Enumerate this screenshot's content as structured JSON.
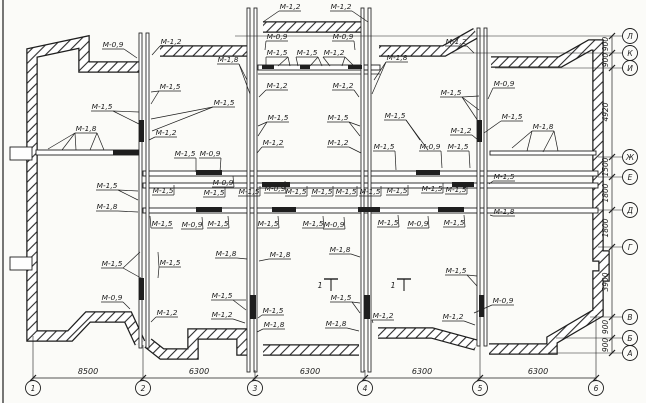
{
  "drawing": {
    "title": "floor-plan-with-mortar-marks",
    "canvas": {
      "w": 646,
      "h": 403
    },
    "colors": {
      "ink": "#1e1e1e",
      "paper": "#fbfbf8",
      "wall_fill": "#ffffff"
    },
    "frame_line_x": 3
  },
  "walls": {
    "outer_path": "M140,343 L128,317 L88,317 L70,336 L32,336 L32,53 L84,42 L84,67 L140,67 M160,51 L247,51 M263,27 L364,27 M379,51 L444,51 L476,33 M491,62 L560,62 L590,45 L598,45 L598,256 L604,256 L604,276 L598,276 L598,313 L552,340 L552,349 L489,349 M476,345 L432,333 L378,333 M359,350 L263,350 M247,350 L242,350 L242,334 L193,334 L193,354 L162,354 L148,343",
    "outline_width": 11.5,
    "hatch_width": 9,
    "inner": [
      {
        "x": 36,
        "y": 150,
        "w": 104,
        "h": 5
      },
      {
        "x": 490,
        "y": 151,
        "w": 106,
        "h": 4
      },
      {
        "x": 143,
        "y": 171,
        "w": 455,
        "h": 5
      },
      {
        "x": 143,
        "y": 183,
        "w": 455,
        "h": 5
      },
      {
        "x": 143,
        "y": 208,
        "w": 455,
        "h": 5
      },
      {
        "x": 258,
        "y": 65,
        "w": 122,
        "h": 5
      }
    ],
    "thin_lines": [
      {
        "x1": 258,
        "y1": 74,
        "x2": 380,
        "y2": 74
      }
    ],
    "shafts": [
      {
        "x": 139,
        "y": 33,
        "w": 3,
        "h": 315
      },
      {
        "x": 146,
        "y": 33,
        "w": 3,
        "h": 315
      },
      {
        "x": 247,
        "y": 8,
        "w": 3,
        "h": 364
      },
      {
        "x": 254,
        "y": 8,
        "w": 3,
        "h": 364
      },
      {
        "x": 361,
        "y": 8,
        "w": 3,
        "h": 364
      },
      {
        "x": 368,
        "y": 8,
        "w": 3,
        "h": 364
      },
      {
        "x": 477,
        "y": 28,
        "w": 3,
        "h": 318
      },
      {
        "x": 484,
        "y": 28,
        "w": 3,
        "h": 318
      }
    ],
    "black_segments": [
      [
        139,
        120,
        5,
        22
      ],
      [
        139,
        278,
        5,
        22
      ],
      [
        250,
        295,
        6,
        24
      ],
      [
        364,
        295,
        6,
        24
      ],
      [
        477,
        120,
        5,
        22
      ],
      [
        479,
        295,
        5,
        22
      ],
      [
        113,
        150,
        26,
        5
      ],
      [
        262,
        65,
        12,
        4
      ],
      [
        300,
        65,
        10,
        4
      ],
      [
        348,
        65,
        14,
        4
      ],
      [
        196,
        170,
        26,
        5
      ],
      [
        416,
        170,
        24,
        5
      ],
      [
        262,
        182,
        28,
        5
      ],
      [
        452,
        182,
        22,
        5
      ],
      [
        196,
        207,
        26,
        5
      ],
      [
        272,
        207,
        24,
        5
      ],
      [
        358,
        207,
        22,
        5
      ],
      [
        438,
        207,
        26,
        5
      ]
    ],
    "tabs": [
      [
        10,
        147,
        22,
        13
      ],
      [
        10,
        257,
        22,
        13
      ]
    ]
  },
  "labels": [
    {
      "t": "М-1,2",
      "x": 290,
      "y": 7,
      "to": [
        [
          263,
          22
        ]
      ]
    },
    {
      "t": "М-1,2",
      "x": 341,
      "y": 7,
      "to": [
        [
          368,
          22
        ]
      ]
    },
    {
      "t": "М-0,9",
      "x": 113,
      "y": 45,
      "to": [
        [
          137,
          58
        ]
      ]
    },
    {
      "t": "М-1,2",
      "x": 171,
      "y": 42,
      "to": [
        [
          152,
          55
        ]
      ]
    },
    {
      "t": "М-0,9",
      "x": 277,
      "y": 37,
      "to": [
        [
          265,
          50
        ]
      ]
    },
    {
      "t": "М-0,9",
      "x": 343,
      "y": 37,
      "to": [
        [
          355,
          50
        ]
      ]
    },
    {
      "t": "М-1,2",
      "x": 456,
      "y": 42,
      "to": [
        [
          474,
          53
        ]
      ]
    },
    {
      "t": "М-1,8",
      "x": 228,
      "y": 60,
      "to": [
        [
          247,
          80
        ],
        [
          250,
          94
        ]
      ]
    },
    {
      "t": "М-1,5",
      "x": 277,
      "y": 53,
      "to": [
        [
          266,
          66
        ],
        [
          278,
          66
        ],
        [
          290,
          66
        ]
      ]
    },
    {
      "t": "М-1,5",
      "x": 307,
      "y": 53,
      "to": [
        [
          298,
          66
        ],
        [
          310,
          66
        ],
        [
          322,
          66
        ]
      ]
    },
    {
      "t": "М-1,2",
      "x": 334,
      "y": 53,
      "to": [
        [
          330,
          66
        ],
        [
          342,
          66
        ],
        [
          354,
          66
        ]
      ]
    },
    {
      "t": "М-1,8",
      "x": 397,
      "y": 58,
      "to": [
        [
          374,
          80
        ],
        [
          372,
          94
        ]
      ]
    },
    {
      "t": "М-0,9",
      "x": 504,
      "y": 84,
      "to": [
        [
          488,
          99
        ]
      ]
    },
    {
      "t": "М-1,5",
      "x": 451,
      "y": 93,
      "to": [
        [
          479,
          96
        ],
        [
          479,
          110
        ],
        [
          480,
          124
        ]
      ]
    },
    {
      "t": "М-1,5",
      "x": 512,
      "y": 117,
      "to": [
        [
          484,
          133
        ]
      ]
    },
    {
      "t": "М-1,2",
      "x": 461,
      "y": 131,
      "to": [
        [
          478,
          140
        ]
      ]
    },
    {
      "t": "М-1,8",
      "x": 543,
      "y": 127,
      "to": [
        [
          512,
          148
        ],
        [
          527,
          151
        ],
        [
          543,
          152
        ],
        [
          558,
          151
        ]
      ]
    },
    {
      "t": "М-1,5",
      "x": 170,
      "y": 87,
      "to": [
        [
          151,
          92
        ],
        [
          151,
          104
        ]
      ]
    },
    {
      "t": "М-1,5",
      "x": 102,
      "y": 107,
      "to": [
        [
          139,
          112
        ],
        [
          139,
          124
        ]
      ]
    },
    {
      "t": "М-1,8",
      "x": 86,
      "y": 129,
      "to": [
        [
          48,
          149
        ],
        [
          62,
          150
        ],
        [
          76,
          150
        ],
        [
          90,
          150
        ],
        [
          104,
          150
        ]
      ]
    },
    {
      "t": "М-1,2",
      "x": 166,
      "y": 133,
      "to": [
        [
          149,
          140
        ]
      ]
    },
    {
      "t": "М-1,5",
      "x": 224,
      "y": 103,
      "to": [
        [
          151,
          119
        ],
        [
          152,
          131
        ]
      ]
    },
    {
      "t": "М-1,2",
      "x": 277,
      "y": 86,
      "to": [
        [
          259,
          97
        ]
      ]
    },
    {
      "t": "М-1,2",
      "x": 343,
      "y": 86,
      "to": [
        [
          359,
          97
        ]
      ]
    },
    {
      "t": "М-1,5",
      "x": 278,
      "y": 118,
      "to": [
        [
          258,
          126
        ],
        [
          258,
          136
        ]
      ]
    },
    {
      "t": "М-1,5",
      "x": 338,
      "y": 118,
      "to": [
        [
          360,
          126
        ],
        [
          360,
          136
        ]
      ]
    },
    {
      "t": "М-1,2",
      "x": 273,
      "y": 143,
      "to": [
        [
          257,
          153
        ]
      ]
    },
    {
      "t": "М-1,2",
      "x": 338,
      "y": 143,
      "to": [
        [
          361,
          153
        ]
      ]
    },
    {
      "t": "М-1,5",
      "x": 395,
      "y": 116,
      "to": [
        [
          420,
          140
        ],
        [
          428,
          150
        ]
      ]
    },
    {
      "t": "М-1,5",
      "x": 185,
      "y": 154,
      "to": [
        [
          196,
          172
        ]
      ]
    },
    {
      "t": "М-0,9",
      "x": 210,
      "y": 154,
      "to": [
        [
          220,
          172
        ]
      ]
    },
    {
      "t": "М-1,5",
      "x": 163,
      "y": 191,
      "to": [
        [
          174,
          185
        ]
      ]
    },
    {
      "t": "М-0,9",
      "x": 223,
      "y": 183,
      "to": [
        [
          233,
          176
        ]
      ]
    },
    {
      "t": "М-1,5",
      "x": 214,
      "y": 193,
      "to": [
        [
          225,
          187
        ]
      ]
    },
    {
      "t": "М-1,5",
      "x": 249,
      "y": 192,
      "to": [
        [
          260,
          186
        ]
      ]
    },
    {
      "t": "М-0,9",
      "x": 275,
      "y": 189,
      "to": [
        [
          285,
          181
        ]
      ]
    },
    {
      "t": "М-1,5",
      "x": 296,
      "y": 192,
      "to": [
        [
          307,
          186
        ]
      ]
    },
    {
      "t": "М-1,5",
      "x": 322,
      "y": 192,
      "to": [
        [
          333,
          186
        ]
      ]
    },
    {
      "t": "М-1,5",
      "x": 346,
      "y": 192,
      "to": [
        [
          357,
          186
        ]
      ]
    },
    {
      "t": "М-1,5",
      "x": 370,
      "y": 192,
      "to": [
        [
          381,
          186
        ]
      ]
    },
    {
      "t": "М-1,5",
      "x": 397,
      "y": 191,
      "to": [
        [
          408,
          185
        ]
      ]
    },
    {
      "t": "М-1,5",
      "x": 432,
      "y": 189,
      "to": [
        [
          443,
          183
        ]
      ]
    },
    {
      "t": "М-1,5",
      "x": 456,
      "y": 190,
      "to": [
        [
          467,
          184
        ]
      ]
    },
    {
      "t": "М-1,5",
      "x": 384,
      "y": 147,
      "to": [
        [
          396,
          170
        ]
      ]
    },
    {
      "t": "М-0,9",
      "x": 430,
      "y": 147,
      "to": [
        [
          442,
          168
        ]
      ]
    },
    {
      "t": "М-1,5",
      "x": 458,
      "y": 147,
      "to": [
        [
          470,
          168
        ]
      ]
    },
    {
      "t": "М-1,5",
      "x": 504,
      "y": 177,
      "to": [
        [
          489,
          184
        ]
      ]
    },
    {
      "t": "М-1,8",
      "x": 504,
      "y": 212,
      "to": [
        [
          490,
          215
        ]
      ]
    },
    {
      "t": "М-1,5",
      "x": 162,
      "y": 224,
      "to": [
        [
          150,
          216
        ]
      ]
    },
    {
      "t": "М-0,9",
      "x": 192,
      "y": 225,
      "to": [
        [
          202,
          217
        ]
      ]
    },
    {
      "t": "М-1,5",
      "x": 218,
      "y": 224,
      "to": [
        [
          228,
          216
        ]
      ]
    },
    {
      "t": "М-1,5",
      "x": 268,
      "y": 224,
      "to": [
        [
          278,
          216
        ]
      ]
    },
    {
      "t": "М-1,5",
      "x": 313,
      "y": 224,
      "to": [
        [
          323,
          216
        ]
      ]
    },
    {
      "t": "М-0,9",
      "x": 334,
      "y": 225,
      "to": [
        [
          344,
          217
        ]
      ]
    },
    {
      "t": "М-1,5",
      "x": 388,
      "y": 223,
      "to": [
        [
          398,
          215
        ]
      ]
    },
    {
      "t": "М-0,9",
      "x": 418,
      "y": 224,
      "to": [
        [
          428,
          216
        ]
      ]
    },
    {
      "t": "М-1,5",
      "x": 454,
      "y": 223,
      "to": [
        [
          464,
          215
        ]
      ]
    },
    {
      "t": "М-1,8",
      "x": 226,
      "y": 254,
      "to": [
        [
          247,
          259
        ]
      ]
    },
    {
      "t": "М-1,8",
      "x": 280,
      "y": 255,
      "to": [
        [
          259,
          261
        ]
      ]
    },
    {
      "t": "М-1,8",
      "x": 340,
      "y": 250,
      "to": [
        [
          360,
          257
        ]
      ]
    },
    {
      "t": "М-1,5",
      "x": 107,
      "y": 186,
      "to": [
        [
          138,
          191
        ],
        [
          138,
          200
        ]
      ]
    },
    {
      "t": "М-1,8",
      "x": 107,
      "y": 207,
      "to": [
        [
          138,
          212
        ]
      ]
    },
    {
      "t": "М-1,5",
      "x": 112,
      "y": 264,
      "to": [
        [
          140,
          252
        ],
        [
          141,
          278
        ]
      ]
    },
    {
      "t": "М-1,5",
      "x": 170,
      "y": 263,
      "to": [
        [
          158,
          252
        ],
        [
          158,
          278
        ]
      ]
    },
    {
      "t": "М-0,9",
      "x": 112,
      "y": 298,
      "to": [
        [
          130,
          309
        ]
      ]
    },
    {
      "t": "М-1,2",
      "x": 167,
      "y": 313,
      "to": [
        [
          151,
          322
        ]
      ]
    },
    {
      "t": "М-1,5",
      "x": 222,
      "y": 296,
      "to": [
        [
          246,
          300
        ],
        [
          246,
          310
        ]
      ]
    },
    {
      "t": "М-1,2",
      "x": 222,
      "y": 315,
      "to": [
        [
          245,
          323
        ]
      ]
    },
    {
      "t": "М-1,5",
      "x": 273,
      "y": 311,
      "to": [
        [
          258,
          318
        ]
      ]
    },
    {
      "t": "М-1,8",
      "x": 274,
      "y": 325,
      "to": [
        [
          257,
          332
        ]
      ]
    },
    {
      "t": "М-1,5",
      "x": 341,
      "y": 298,
      "to": [
        [
          360,
          303
        ],
        [
          360,
          313
        ]
      ]
    },
    {
      "t": "М-1,8",
      "x": 336,
      "y": 324,
      "to": [
        [
          359,
          331
        ]
      ]
    },
    {
      "t": "М-1,2",
      "x": 383,
      "y": 316,
      "to": [
        [
          373,
          323
        ]
      ]
    },
    {
      "t": "М-1,5",
      "x": 456,
      "y": 271,
      "to": [
        [
          477,
          276
        ],
        [
          477,
          286
        ]
      ]
    },
    {
      "t": "М-0,9",
      "x": 503,
      "y": 301,
      "to": [
        [
          474,
          313
        ]
      ]
    },
    {
      "t": "М-1,2",
      "x": 453,
      "y": 317,
      "to": [
        [
          475,
          325
        ]
      ]
    }
  ],
  "section_marks": [
    {
      "t": "1",
      "x": 328,
      "y": 284
    },
    {
      "t": "1",
      "x": 401,
      "y": 284
    }
  ],
  "axes": {
    "bottom": {
      "cy": 388,
      "r": 7.5,
      "dim_line_y": 378,
      "circles": [
        {
          "t": "1",
          "x": 33
        },
        {
          "t": "2",
          "x": 143
        },
        {
          "t": "3",
          "x": 255
        },
        {
          "t": "4",
          "x": 365
        },
        {
          "t": "5",
          "x": 480
        },
        {
          "t": "6",
          "x": 596
        }
      ],
      "dims": [
        {
          "t": "8500",
          "x": 88
        },
        {
          "t": "6300",
          "x": 199
        },
        {
          "t": "6300",
          "x": 310
        },
        {
          "t": "6300",
          "x": 422
        },
        {
          "t": "6300",
          "x": 538
        }
      ],
      "ext_top": [
        336,
        345,
        370,
        370,
        346,
        315
      ]
    },
    "right": {
      "cx": 630,
      "r": 7.5,
      "dim_line_x": 612,
      "circles": [
        {
          "t": "Л",
          "y": 36
        },
        {
          "t": "К",
          "y": 53
        },
        {
          "t": "И",
          "y": 68
        },
        {
          "t": "Ж",
          "y": 157
        },
        {
          "t": "Е",
          "y": 177
        },
        {
          "t": "Д",
          "y": 210
        },
        {
          "t": "Г",
          "y": 247
        },
        {
          "t": "В",
          "y": 317
        },
        {
          "t": "Б",
          "y": 338
        },
        {
          "t": "А",
          "y": 353
        }
      ],
      "dims": [
        {
          "t": "900",
          "y": 44
        },
        {
          "t": "900",
          "y": 60
        },
        {
          "t": "4920",
          "y": 112
        },
        {
          "t": "1500",
          "y": 167
        },
        {
          "t": "1800",
          "y": 193
        },
        {
          "t": "1800",
          "y": 228
        },
        {
          "t": "3900",
          "y": 282
        },
        {
          "t": "900",
          "y": 327
        },
        {
          "t": "900",
          "y": 345
        }
      ],
      "ext_left": [
        235,
        450,
        495,
        598,
        598,
        598,
        598,
        590,
        556,
        548
      ]
    }
  }
}
